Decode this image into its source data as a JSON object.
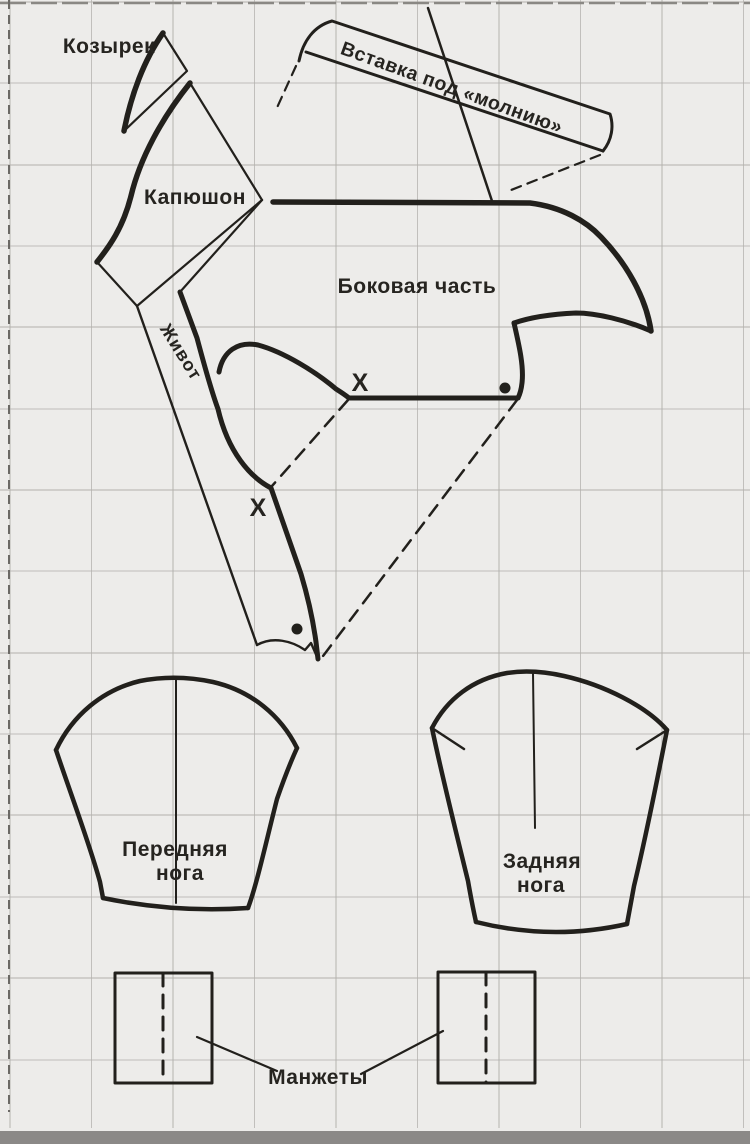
{
  "diagram": {
    "title_hint": "dog-overall sewing pattern sheet on grid paper",
    "pieces": {
      "visor": {
        "label": "Козырек"
      },
      "hood": {
        "label": "Капюшон"
      },
      "zipper_insert": {
        "label": "Вставка под «молнию»"
      },
      "side_part": {
        "label": "Боковая часть"
      },
      "belly": {
        "label": "Живот"
      },
      "front_leg": {
        "label": "Передняя",
        "label2": "нога"
      },
      "back_leg": {
        "label": "Задняя",
        "label2": "нога"
      },
      "cuffs": {
        "label": "Манжеты"
      }
    },
    "marks": {
      "x": "X"
    },
    "colors": {
      "paper": "#edecea",
      "grid": "#b2b0ac",
      "ink": "#22201c",
      "bottom_bar": "#8b8987"
    }
  }
}
